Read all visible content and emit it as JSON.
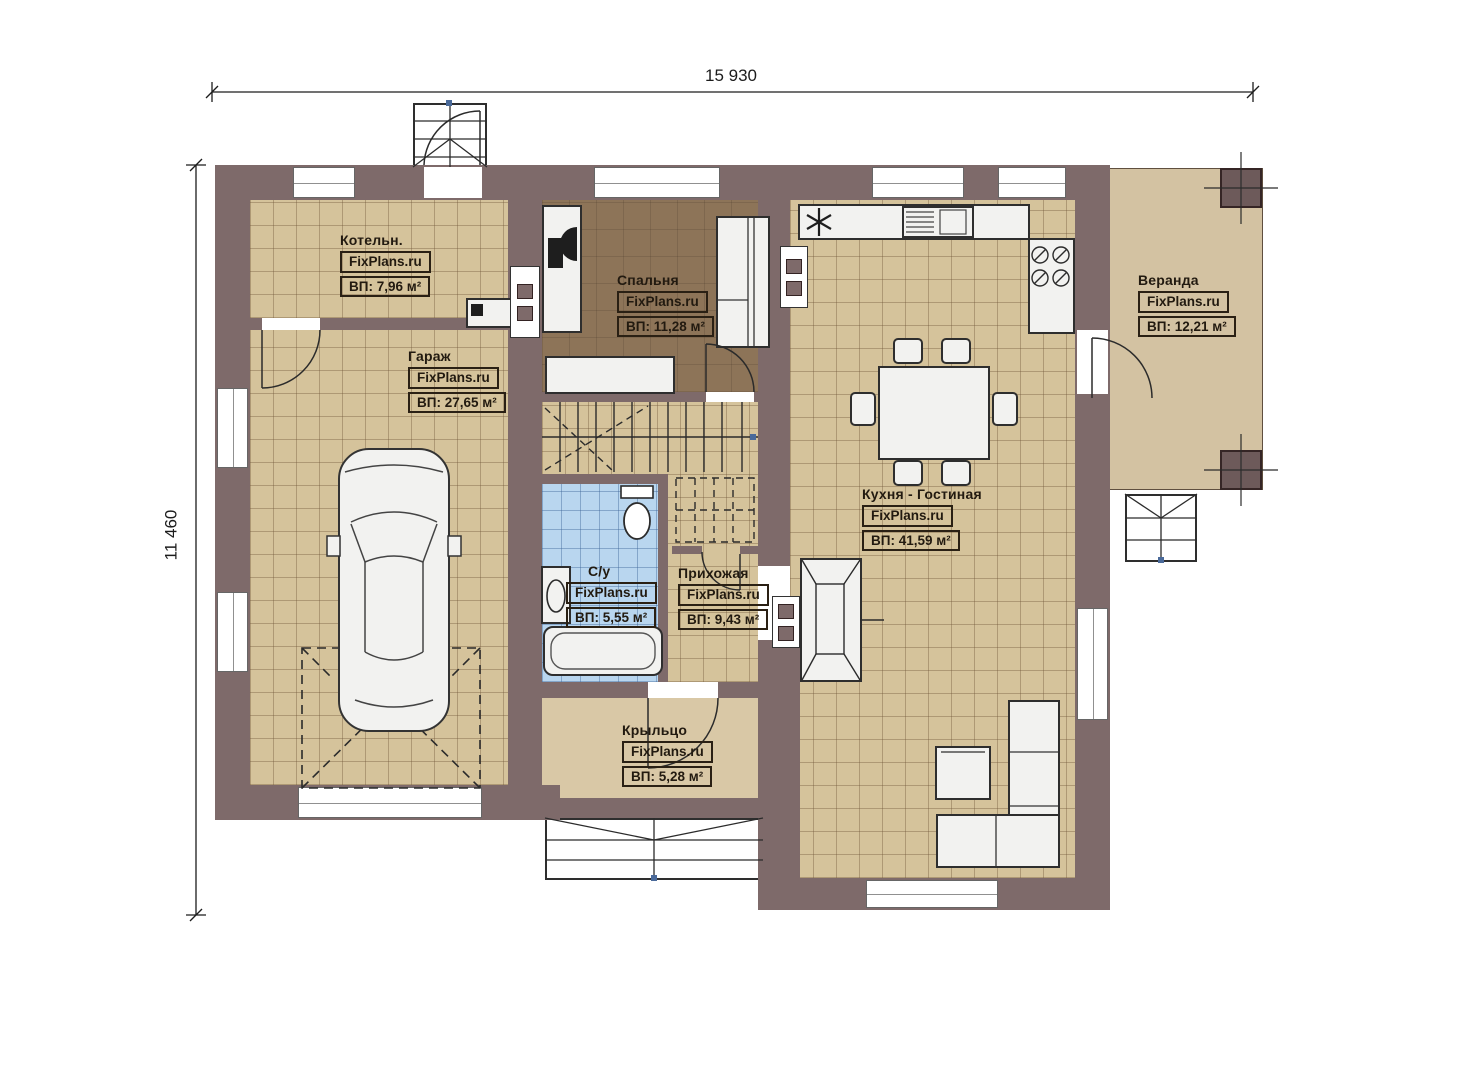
{
  "brand": "FixPlans.ru",
  "dimensions": {
    "top": "15 930",
    "left": "11 460"
  },
  "rooms": [
    {
      "key": "boiler",
      "name": "Котельн.",
      "brand": "FixPlans.ru",
      "area": "ВП: 7,96 м²"
    },
    {
      "key": "garage",
      "name": "Гараж",
      "brand": "FixPlans.ru",
      "area": "ВП: 27,65 м²"
    },
    {
      "key": "bedroom",
      "name": "Спальня",
      "brand": "FixPlans.ru",
      "area": "ВП: 11,28 м²"
    },
    {
      "key": "kitchen_living",
      "name": "Кухня - Гостиная",
      "brand": "FixPlans.ru",
      "area": "ВП: 41,59 м²"
    },
    {
      "key": "veranda",
      "name": "Веранда",
      "brand": "FixPlans.ru",
      "area": "ВП: 12,21 м²"
    },
    {
      "key": "bathroom",
      "name": "С/у",
      "brand": "FixPlans.ru",
      "area": "ВП: 5,55 м²"
    },
    {
      "key": "hallway",
      "name": "Прихожая",
      "brand": "FixPlans.ru",
      "area": "ВП: 9,43 м²"
    },
    {
      "key": "porch",
      "name": "Крыльцо",
      "brand": "FixPlans.ru",
      "area": "ВП: 5,28 м²"
    }
  ],
  "colors": {
    "wall": "#7e6a6a",
    "floor_tile": "#d5c39b",
    "bedroom_floor": "#8d7458",
    "bath_floor": "#b9d6ef",
    "porch_floor": "#d9c8a6",
    "veranda_floor": "#d3c2a2",
    "fixture": "#f2f2f0",
    "marker_blue": "#4a6a9a"
  }
}
